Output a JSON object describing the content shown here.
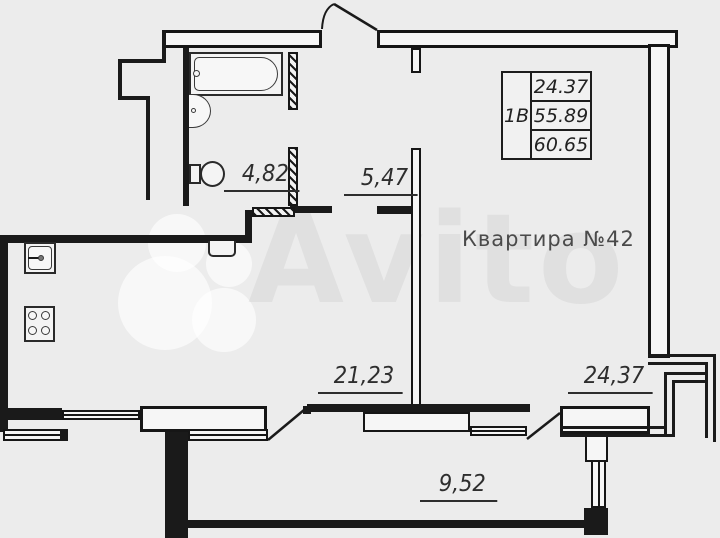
{
  "title": "Квартира №42",
  "watermark": "Avito",
  "info_table": {
    "apartment_type": "1В",
    "row1": "24.37",
    "row2": "55.89",
    "row3": "60.65"
  },
  "areas": {
    "bathroom": "4,82",
    "hallway": "5,47",
    "kitchen_living": "21,23",
    "room": "24,37",
    "balcony": "9,52"
  }
}
